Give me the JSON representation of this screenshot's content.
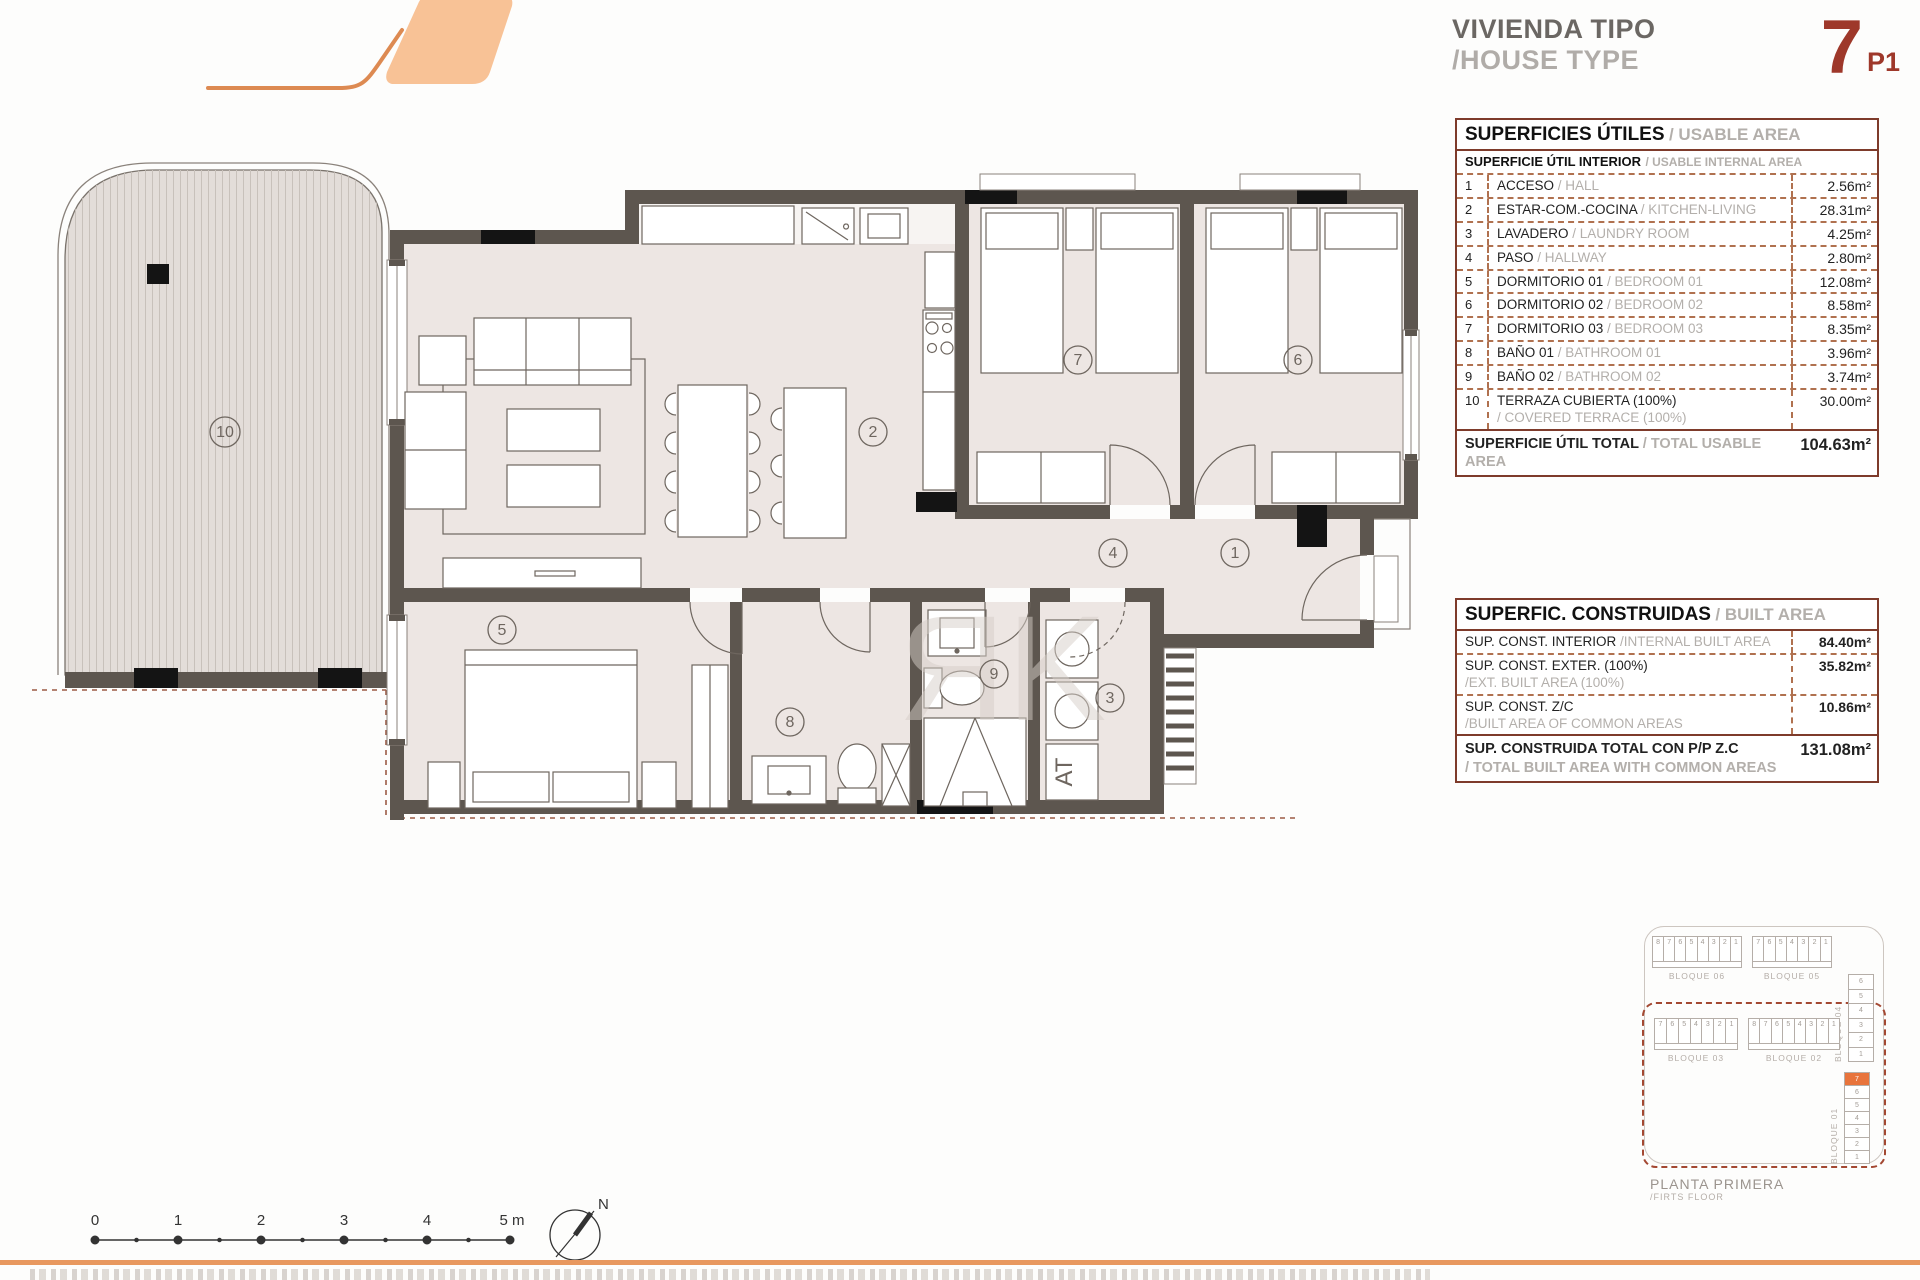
{
  "header": {
    "title_es": "VIVIENDA TIPO",
    "title_en": "/HOUSE TYPE",
    "type_number": "7",
    "floor_code": "P1"
  },
  "usable_table": {
    "title_es": "SUPERFICIES ÚTILES",
    "title_en": "/ USABLE AREA",
    "subtitle_es": "SUPERFICIE ÚTIL INTERIOR",
    "subtitle_en": "/ USABLE INTERNAL AREA",
    "rows": [
      {
        "num": "1",
        "es": "ACCESO",
        "en": "/ HALL",
        "value": "2.56m²",
        "stacked": false
      },
      {
        "num": "2",
        "es": "ESTAR-COM.-COCINA",
        "en": "/ KITCHEN-LIVING",
        "value": "28.31m²",
        "stacked": false
      },
      {
        "num": "3",
        "es": "LAVADERO",
        "en": "/ LAUNDRY ROOM",
        "value": "4.25m²",
        "stacked": false
      },
      {
        "num": "4",
        "es": "PASO",
        "en": "/ HALLWAY",
        "value": "2.80m²",
        "stacked": false
      },
      {
        "num": "5",
        "es": "DORMITORIO 01",
        "en": "/ BEDROOM 01",
        "value": "12.08m²",
        "stacked": false
      },
      {
        "num": "6",
        "es": "DORMITORIO 02",
        "en": "/ BEDROOM 02",
        "value": "8.58m²",
        "stacked": false
      },
      {
        "num": "7",
        "es": "DORMITORIO 03",
        "en": "/ BEDROOM 03",
        "value": "8.35m²",
        "stacked": false
      },
      {
        "num": "8",
        "es": "BAÑO 01",
        "en": "/ BATHROOM 01",
        "value": "3.96m²",
        "stacked": false
      },
      {
        "num": "9",
        "es": "BAÑO 02",
        "en": "/ BATHROOM 02",
        "value": "3.74m²",
        "stacked": false
      },
      {
        "num": "10",
        "es": "TERRAZA CUBIERTA (100%)",
        "en": "/ COVERED TERRACE (100%)",
        "value": "30.00m²",
        "stacked": true
      }
    ],
    "total_es": "SUPERFICIE ÚTIL TOTAL",
    "total_en": "/ TOTAL USABLE AREA",
    "total_value": "104.63m²"
  },
  "built_table": {
    "title_es": "SUPERFIC. CONSTRUIDAS",
    "title_en": "/ BUILT AREA",
    "rows": [
      {
        "es": "SUP. CONST. INTERIOR",
        "en": "/INTERNAL BUILT AREA",
        "value": "84.40m²",
        "stacked": false
      },
      {
        "es": "SUP. CONST. EXTER. (100%)",
        "en": "/EXT. BUILT AREA (100%)",
        "value": "35.82m²",
        "stacked": true
      },
      {
        "es": "SUP. CONST. Z/C",
        "en": "/BUILT AREA OF COMMON AREAS",
        "value": "10.86m²",
        "stacked": true
      }
    ],
    "total_es": "SUP. CONSTRUIDA TOTAL CON P/P Z.C",
    "total_en": "/ TOTAL BUILT AREA WITH COMMON AREAS",
    "total_value": "131.08m²"
  },
  "key_plan": {
    "caption_es": "PLANTA PRIMERA",
    "caption_en": "/FIRTS FLOOR",
    "highlight_block": "BLOQUE 01",
    "highlight_cell": "7",
    "blocks": [
      {
        "label": "BLOQUE 06",
        "orient": "h",
        "x": 12,
        "y": 14,
        "w": 90,
        "cells": [
          "8",
          "7",
          "6",
          "5",
          "4",
          "3",
          "2",
          "1"
        ]
      },
      {
        "label": "BLOQUE 05",
        "orient": "h",
        "x": 112,
        "y": 14,
        "w": 80,
        "cells": [
          "7",
          "6",
          "5",
          "4",
          "3",
          "2",
          "1"
        ]
      },
      {
        "label": "BLOQUE 04",
        "orient": "v",
        "x": 208,
        "y": 52,
        "h": 88,
        "cells": [
          "6",
          "5",
          "4",
          "3",
          "2",
          "1"
        ]
      },
      {
        "label": "BLOQUE 03",
        "orient": "h",
        "x": 14,
        "y": 96,
        "w": 84,
        "cells": [
          "7",
          "6",
          "5",
          "4",
          "3",
          "2",
          "1"
        ]
      },
      {
        "label": "BLOQUE 02",
        "orient": "h",
        "x": 108,
        "y": 96,
        "w": 92,
        "cells": [
          "8",
          "7",
          "6",
          "5",
          "4",
          "3",
          "2",
          "1"
        ]
      },
      {
        "label": "BLOQUE 01",
        "orient": "v",
        "x": 204,
        "y": 150,
        "h": 92,
        "cells": [
          "7",
          "6",
          "5",
          "4",
          "3",
          "2",
          "1"
        ],
        "highlight": "7"
      }
    ]
  },
  "plan": {
    "room_labels": {
      "r1": "1",
      "r2": "2",
      "r3": "3",
      "r4": "4",
      "r5": "5",
      "r6": "6",
      "r7": "7",
      "r8": "8",
      "r9": "9",
      "r10": "10"
    },
    "at_label": "AT",
    "watermark": "ЯK"
  },
  "scale_bar": {
    "labels": [
      "0",
      "1",
      "2",
      "3",
      "4",
      "5 m"
    ]
  },
  "compass": {
    "label": "N"
  },
  "colors": {
    "wall": "#5d564f",
    "floor": "#ede6e3",
    "accent_orange": "#e8743c",
    "logo_fill": "#f8c296",
    "logo_stroke": "#dd8a52",
    "type_red": "#9e382a",
    "table_border": "#7e3b2b",
    "dashed_line": "#9c5b45"
  }
}
